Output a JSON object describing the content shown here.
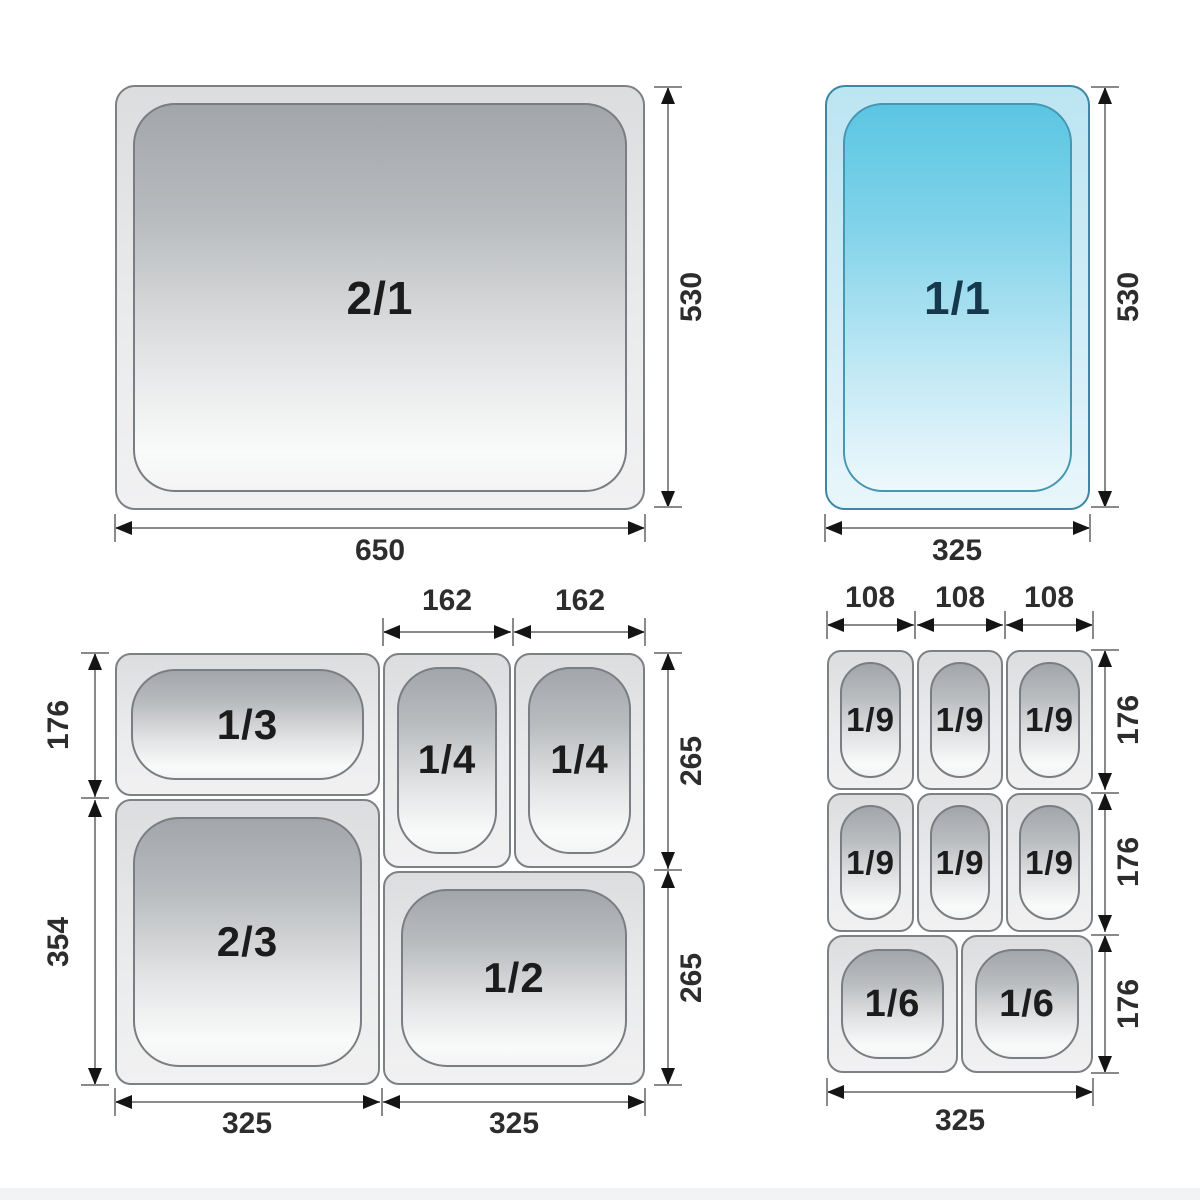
{
  "colors": {
    "steel_gradient_top": "#a2a6aa",
    "steel_gradient_bottom": "#f4f4f5",
    "pan_body_fill": "#e9eaeb",
    "pan_outline": "#7d8084",
    "blue_gradient_top": "#5bc6e2",
    "blue_gradient_bottom": "#edf8fc",
    "blue_outline": "#3c87a4",
    "dimension_line": "#8a8a8a",
    "arrowhead": "#141414",
    "dimension_text": "#2d2d2d",
    "pan_label_text": "#1c1c1c",
    "blue_pan_label_text": "#16384c"
  },
  "gn21": {
    "label": "2/1",
    "height_dim": "530",
    "width_dim": "650"
  },
  "gn11": {
    "label": "1/1",
    "height_dim": "530",
    "width_dim": "325"
  },
  "combo_left": {
    "pans": {
      "third": "1/3",
      "two_thirds": "2/3",
      "quarter_a": "1/4",
      "quarter_b": "1/4",
      "half": "1/2"
    },
    "dims": {
      "top": [
        "162",
        "162"
      ],
      "left": [
        "176",
        "354"
      ],
      "right": [
        "265",
        "265"
      ],
      "bottom": [
        "325",
        "325"
      ]
    }
  },
  "combo_right": {
    "pans": {
      "ninths": [
        "1/9",
        "1/9",
        "1/9",
        "1/9",
        "1/9",
        "1/9"
      ],
      "sixths": [
        "1/6",
        "1/6"
      ]
    },
    "dims": {
      "top": [
        "108",
        "108",
        "108"
      ],
      "right": [
        "176",
        "176",
        "176"
      ],
      "bottom": "325"
    }
  }
}
